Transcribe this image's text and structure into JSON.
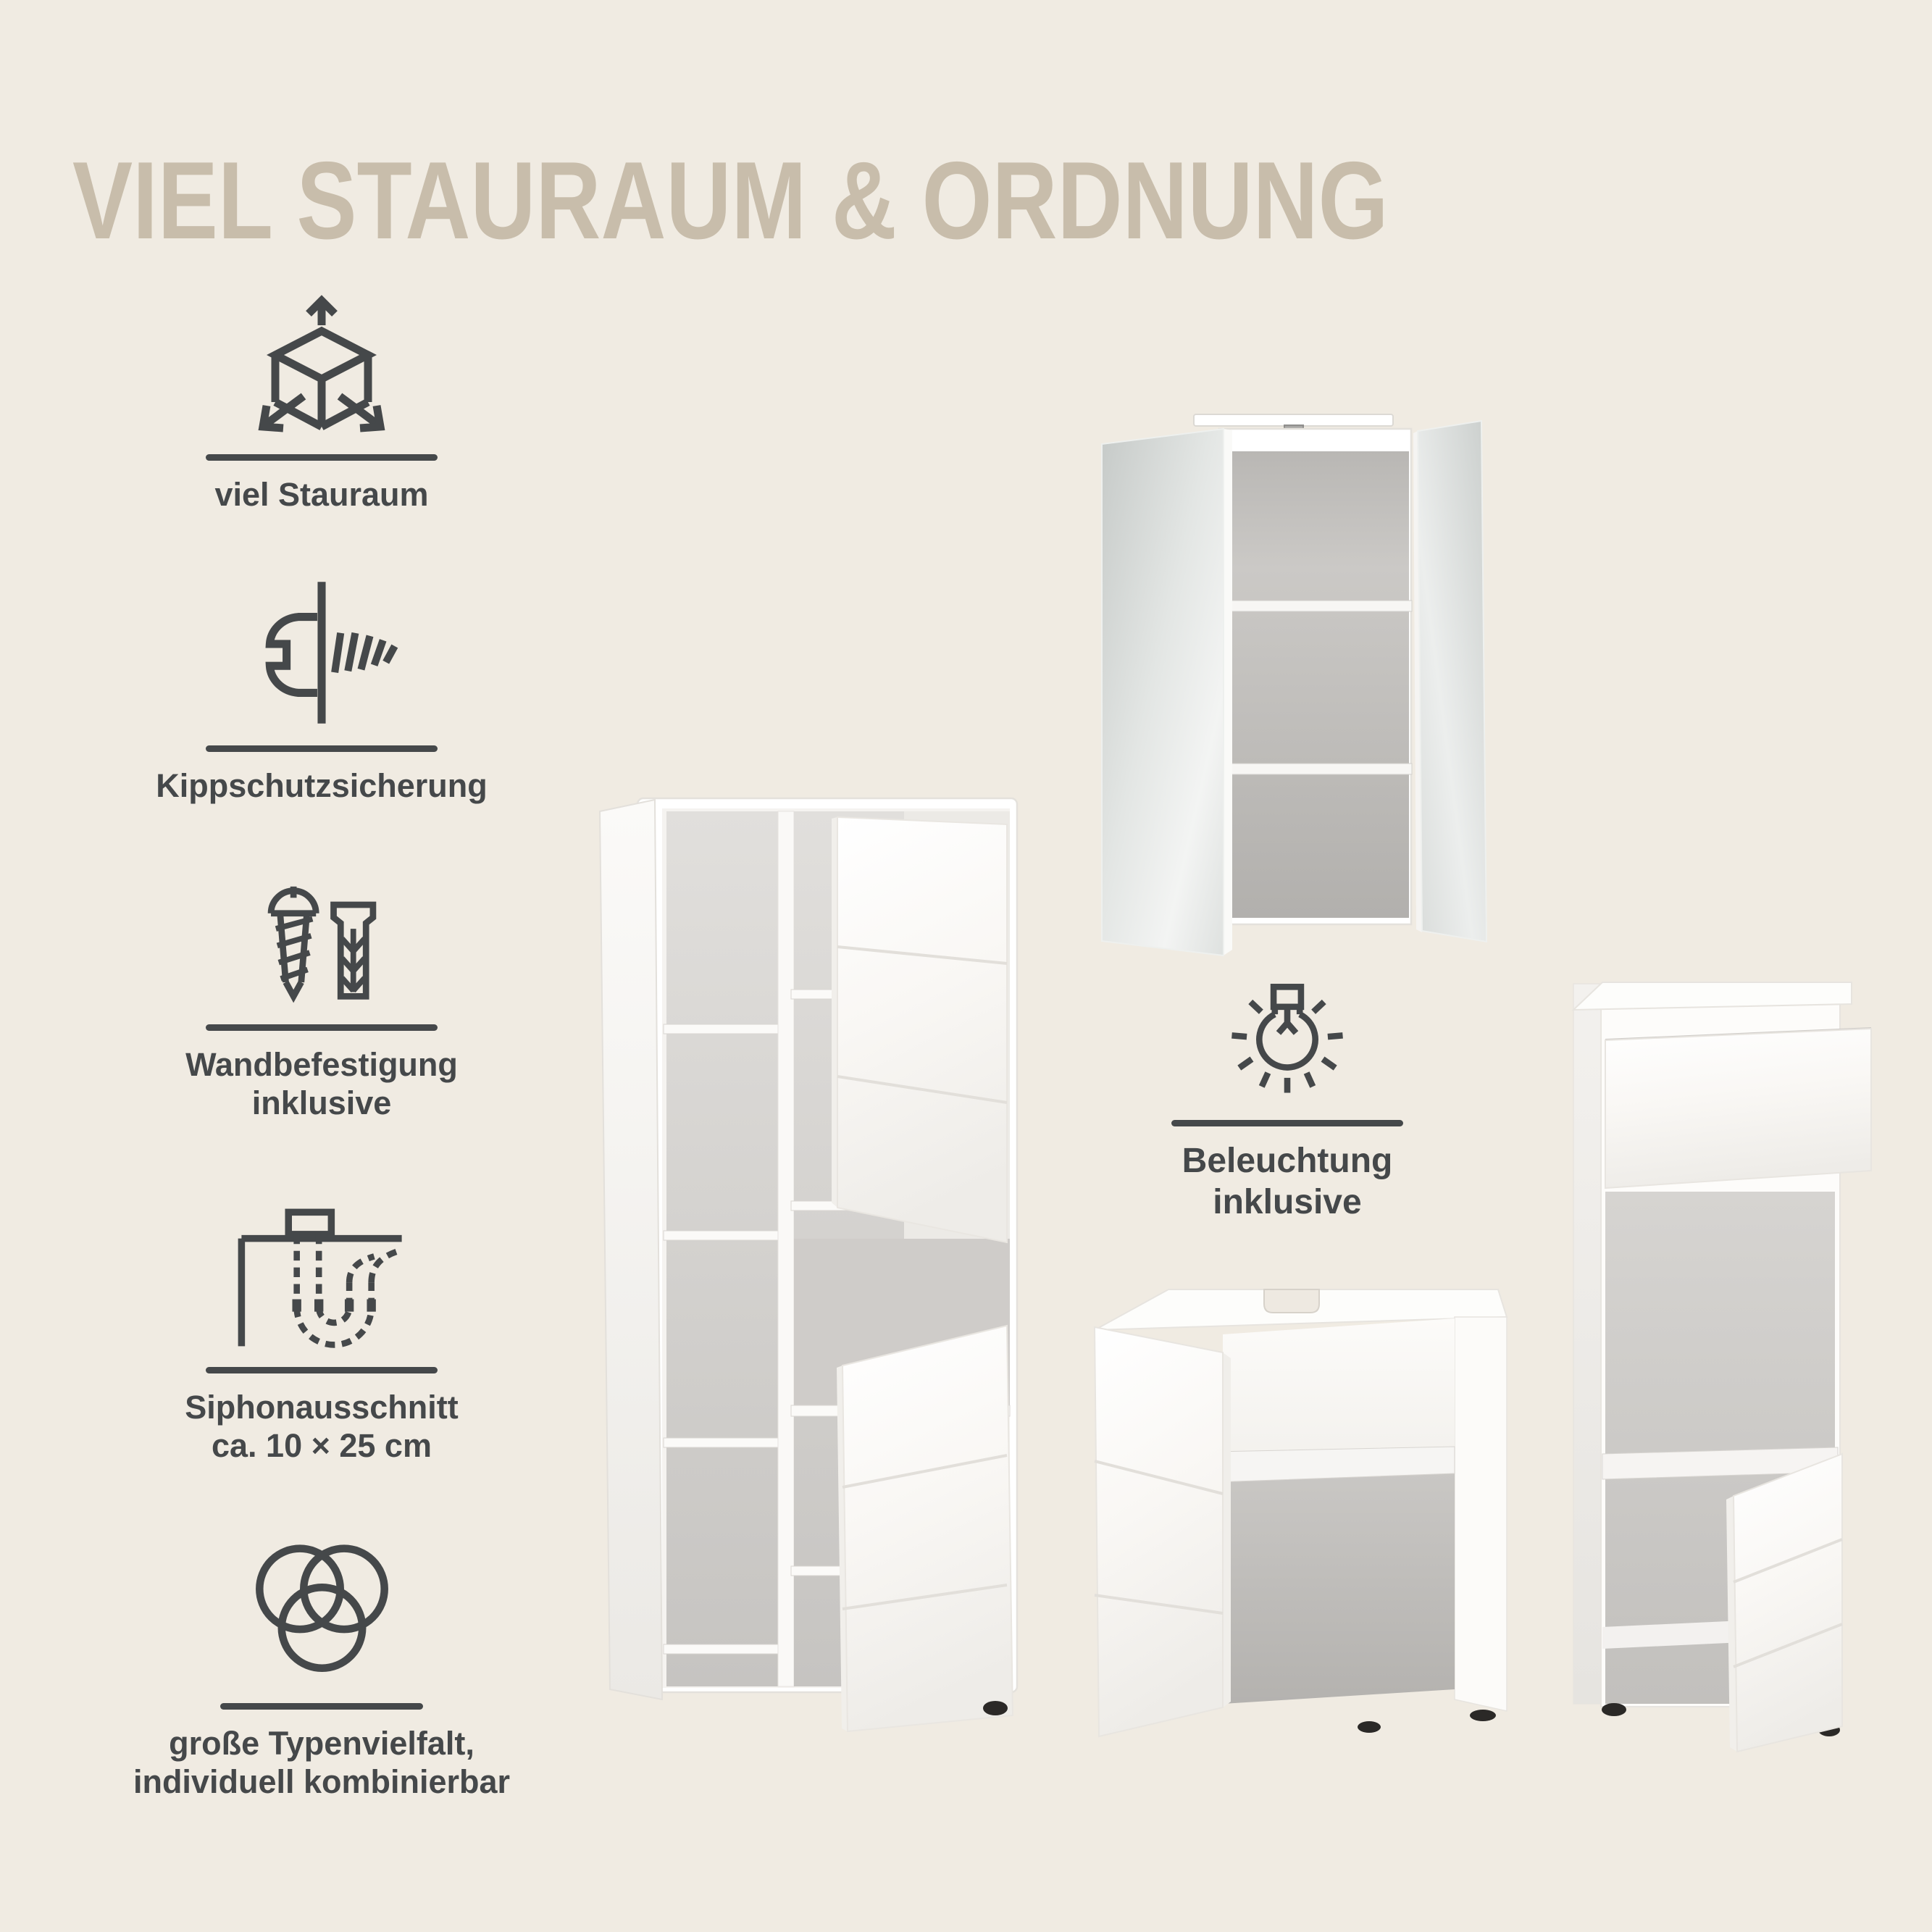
{
  "page": {
    "title": "VIEL STAURAUM & ORDNUNG"
  },
  "theme": {
    "background": "#f0ebe2",
    "title_color": "#c8bdab",
    "text_color": "#45484a",
    "divider_color": "#45484a",
    "furniture_white": "#ffffff",
    "interior_gray": "#c2c0bd",
    "mirror_tint": "#d6dad8",
    "feet_color": "#2b2927"
  },
  "features": [
    {
      "icon": "cube-arrows-icon",
      "label": "viel Stauraum"
    },
    {
      "icon": "anti-tip-lock-icon",
      "label": "Kippschutzsicherung"
    },
    {
      "icon": "screw-dowel-icon",
      "label": "Wandbefestigung\ninklusive"
    },
    {
      "icon": "siphon-cutout-icon",
      "label": "Siphonausschnitt\nca. 10 × 25 cm"
    },
    {
      "icon": "venn-circles-icon",
      "label": "große Typenvielfalt,\nindividuell kombinierbar"
    }
  ],
  "highlight": {
    "icon": "light-bulb-icon",
    "label": "Beleuchtung\ninklusive"
  },
  "furniture": [
    {
      "name": "tall-storage-cabinet"
    },
    {
      "name": "mirror-cabinet-with-light"
    },
    {
      "name": "washbasin-base-cabinet"
    },
    {
      "name": "side-cabinet-with-drawer"
    }
  ]
}
